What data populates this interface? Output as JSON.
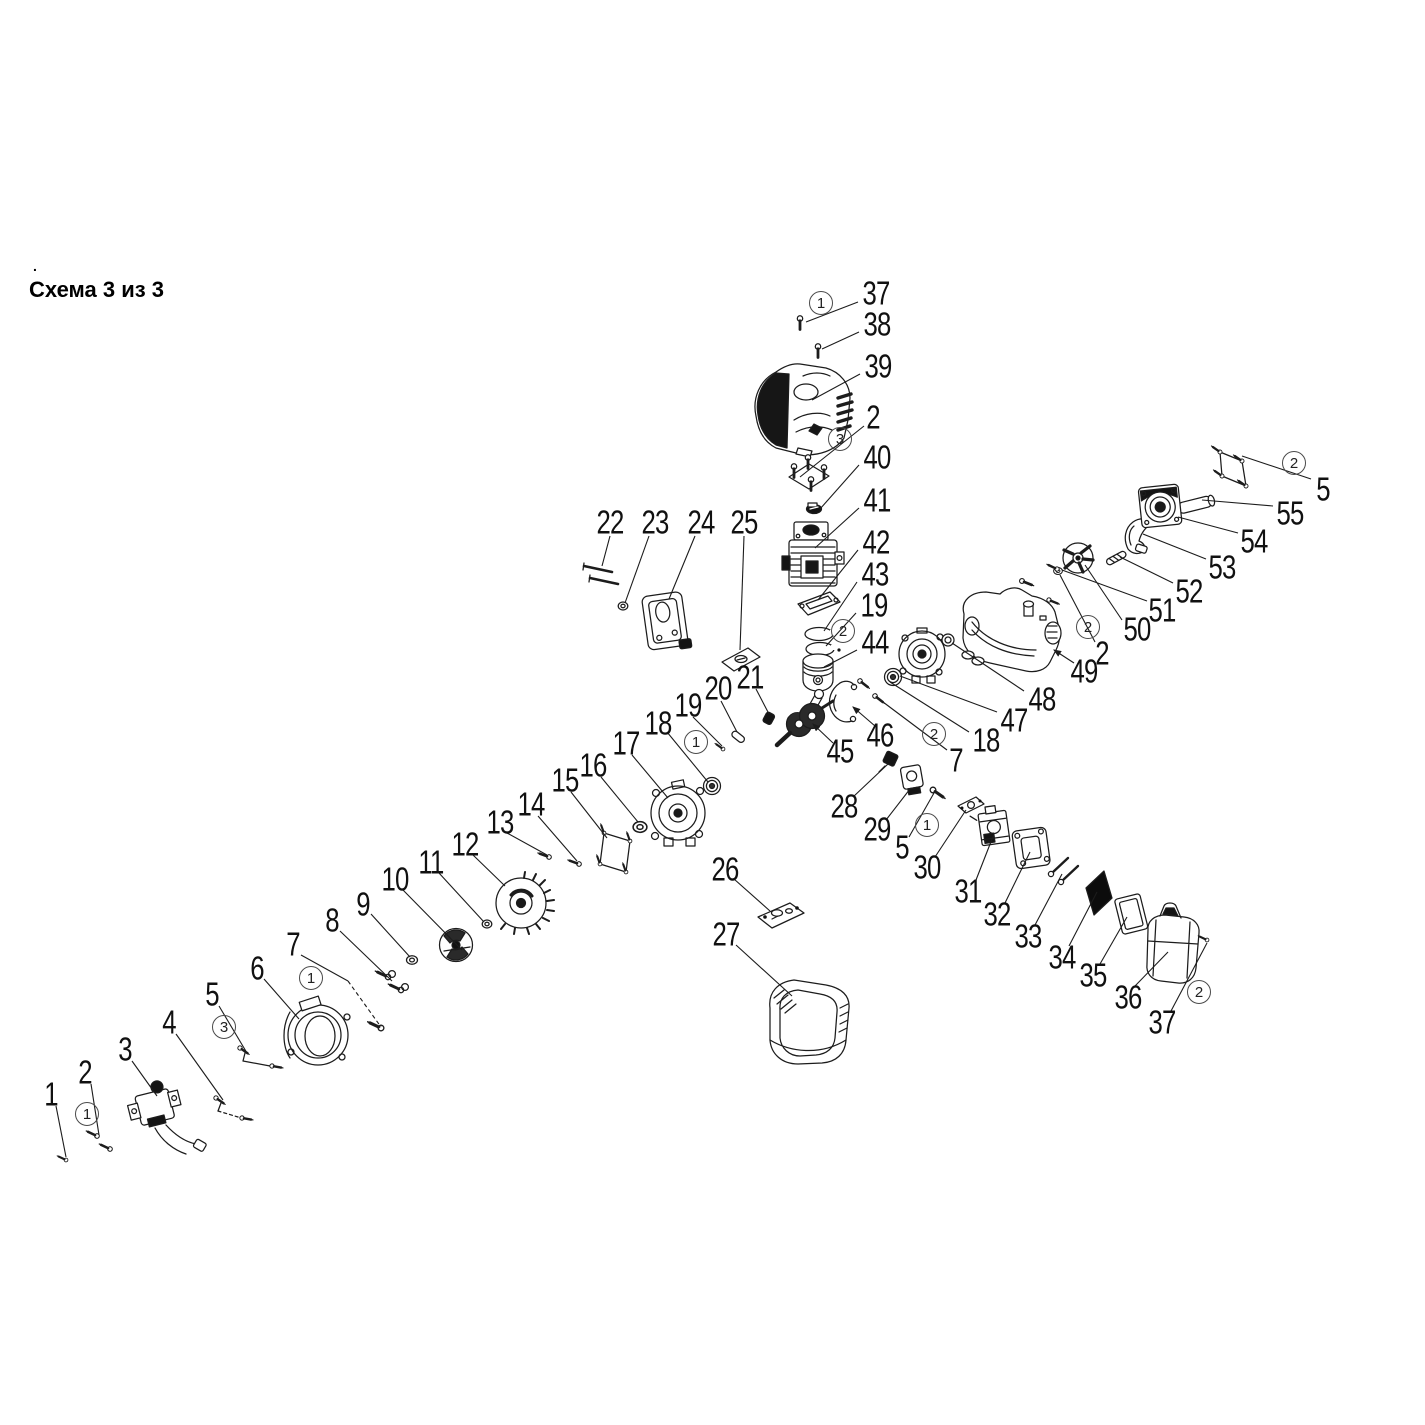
{
  "header": {
    "title": "Схема 3 из 3",
    "dot": "."
  },
  "diagram": {
    "type": "exploded-parts-diagram",
    "callouts": [
      {
        "t": "37",
        "x": 876,
        "y": 293,
        "lead": [
          [
            858,
            302
          ],
          [
            806,
            322
          ]
        ]
      },
      {
        "t": "38",
        "x": 877,
        "y": 324,
        "lead": [
          [
            859,
            332
          ],
          [
            822,
            349
          ]
        ]
      },
      {
        "t": "39",
        "x": 878,
        "y": 366,
        "lead": [
          [
            860,
            374
          ],
          [
            812,
            400
          ]
        ]
      },
      {
        "t": "2",
        "x": 873,
        "y": 417,
        "lead": [
          [
            864,
            426
          ],
          [
            800,
            477
          ]
        ]
      },
      {
        "t": "40",
        "x": 877,
        "y": 457,
        "lead": [
          [
            859,
            465
          ],
          [
            820,
            509
          ]
        ]
      },
      {
        "t": "41",
        "x": 877,
        "y": 500,
        "lead": [
          [
            859,
            508
          ],
          [
            815,
            548
          ]
        ]
      },
      {
        "t": "42",
        "x": 876,
        "y": 542,
        "lead": [
          [
            858,
            550
          ],
          [
            818,
            600
          ]
        ]
      },
      {
        "t": "43",
        "x": 875,
        "y": 574,
        "lead": [
          [
            857,
            582
          ],
          [
            824,
            631
          ]
        ]
      },
      {
        "t": "19",
        "x": 874,
        "y": 605,
        "lead": [
          [
            856,
            613
          ],
          [
            826,
            646
          ]
        ]
      },
      {
        "t": "44",
        "x": 875,
        "y": 642,
        "lead": [
          [
            857,
            650
          ],
          [
            824,
            667
          ]
        ]
      },
      {
        "t": "45",
        "x": 840,
        "y": 751,
        "lead": [
          [
            833,
            743
          ],
          [
            813,
            724
          ]
        ],
        "arrow": true
      },
      {
        "t": "46",
        "x": 880,
        "y": 735,
        "lead": [
          [
            875,
            726
          ],
          [
            853,
            707
          ]
        ],
        "arrow": true
      },
      {
        "t": "47",
        "x": 1014,
        "y": 720,
        "lead": [
          [
            997,
            712
          ],
          [
            900,
            676
          ]
        ]
      },
      {
        "t": "48",
        "x": 1042,
        "y": 699,
        "lead": [
          [
            1024,
            691
          ],
          [
            952,
            643
          ]
        ]
      },
      {
        "t": "18",
        "x": 986,
        "y": 740,
        "lead": [
          [
            969,
            732
          ],
          [
            890,
            682
          ]
        ]
      },
      {
        "t": "7",
        "x": 956,
        "y": 760,
        "lead": [
          [
            947,
            750
          ],
          [
            879,
            699
          ]
        ]
      },
      {
        "t": "49",
        "x": 1084,
        "y": 671,
        "lead": [
          [
            1074,
            663
          ],
          [
            1054,
            650
          ]
        ],
        "arrow": true
      },
      {
        "t": "2",
        "x": 1102,
        "y": 653,
        "lead": [
          [
            1095,
            642
          ],
          [
            1060,
            575
          ]
        ]
      },
      {
        "t": "50",
        "x": 1137,
        "y": 629,
        "lead": [
          [
            1122,
            620
          ],
          [
            1085,
            565
          ]
        ]
      },
      {
        "t": "51",
        "x": 1162,
        "y": 610,
        "lead": [
          [
            1147,
            601
          ],
          [
            1062,
            570
          ]
        ]
      },
      {
        "t": "52",
        "x": 1189,
        "y": 591,
        "lead": [
          [
            1173,
            583
          ],
          [
            1120,
            557
          ]
        ]
      },
      {
        "t": "53",
        "x": 1222,
        "y": 567,
        "lead": [
          [
            1206,
            559
          ],
          [
            1143,
            534
          ]
        ]
      },
      {
        "t": "54",
        "x": 1254,
        "y": 541,
        "lead": [
          [
            1238,
            533
          ],
          [
            1178,
            517
          ]
        ]
      },
      {
        "t": "55",
        "x": 1290,
        "y": 513,
        "lead": [
          [
            1273,
            506
          ],
          [
            1202,
            500
          ]
        ]
      },
      {
        "t": "5",
        "x": 1323,
        "y": 489,
        "lead": [
          [
            1311,
            479
          ],
          [
            1242,
            456
          ]
        ]
      },
      {
        "t": "22",
        "x": 610,
        "y": 522,
        "lead": [
          [
            610,
            536
          ],
          [
            602,
            566
          ]
        ]
      },
      {
        "t": "23",
        "x": 655,
        "y": 522,
        "lead": [
          [
            649,
            536
          ],
          [
            625,
            603
          ]
        ]
      },
      {
        "t": "24",
        "x": 701,
        "y": 522,
        "lead": [
          [
            695,
            536
          ],
          [
            669,
            599
          ]
        ]
      },
      {
        "t": "25",
        "x": 744,
        "y": 522,
        "lead": [
          [
            744,
            536
          ],
          [
            740,
            650
          ]
        ]
      },
      {
        "t": "21",
        "x": 750,
        "y": 677,
        "lead": [
          [
            756,
            689
          ],
          [
            769,
            714
          ]
        ]
      },
      {
        "t": "20",
        "x": 718,
        "y": 688,
        "lead": [
          [
            721,
            701
          ],
          [
            737,
            732
          ]
        ]
      },
      {
        "t": "19",
        "x": 688,
        "y": 705,
        "lead": [
          [
            693,
            717
          ],
          [
            722,
            746
          ]
        ]
      },
      {
        "t": "18",
        "x": 658,
        "y": 723,
        "lead": [
          [
            667,
            732
          ],
          [
            708,
            782
          ]
        ]
      },
      {
        "t": "17",
        "x": 626,
        "y": 743,
        "lead": [
          [
            632,
            755
          ],
          [
            668,
            798
          ]
        ]
      },
      {
        "t": "16",
        "x": 593,
        "y": 765,
        "lead": [
          [
            601,
            777
          ],
          [
            638,
            822
          ]
        ]
      },
      {
        "t": "15",
        "x": 565,
        "y": 780,
        "lead": [
          [
            571,
            792
          ],
          [
            607,
            838
          ]
        ]
      },
      {
        "t": "14",
        "x": 531,
        "y": 804,
        "lead": [
          [
            538,
            816
          ],
          [
            577,
            861
          ]
        ]
      },
      {
        "t": "13",
        "x": 500,
        "y": 822,
        "lead": [
          [
            507,
            833
          ],
          [
            547,
            855
          ]
        ]
      },
      {
        "t": "12",
        "x": 465,
        "y": 844,
        "lead": [
          [
            473,
            855
          ],
          [
            505,
            886
          ]
        ]
      },
      {
        "t": "11",
        "x": 431,
        "y": 862,
        "lead": [
          [
            439,
            873
          ],
          [
            484,
            922
          ]
        ]
      },
      {
        "t": "10",
        "x": 395,
        "y": 879,
        "lead": [
          [
            403,
            890
          ],
          [
            462,
            950
          ]
        ]
      },
      {
        "t": "9",
        "x": 363,
        "y": 904,
        "lead": [
          [
            371,
            914
          ],
          [
            410,
            957
          ]
        ]
      },
      {
        "t": "8",
        "x": 332,
        "y": 920,
        "lead": [
          [
            340,
            931
          ],
          [
            392,
            981
          ]
        ]
      },
      {
        "t": "7",
        "x": 293,
        "y": 944,
        "lead": [
          [
            301,
            955
          ],
          [
            348,
            981
          ]
        ],
        "lead2": [
          [
            348,
            981
          ],
          [
            381,
            1027
          ]
        ]
      },
      {
        "t": "6",
        "x": 257,
        "y": 968,
        "lead": [
          [
            264,
            979
          ],
          [
            299,
            1019
          ]
        ]
      },
      {
        "t": "5",
        "x": 212,
        "y": 994,
        "lead": [
          [
            219,
            1006
          ],
          [
            247,
            1053
          ]
        ]
      },
      {
        "t": "4",
        "x": 169,
        "y": 1022,
        "lead": [
          [
            176,
            1034
          ],
          [
            223,
            1100
          ]
        ]
      },
      {
        "t": "3",
        "x": 125,
        "y": 1049,
        "lead": [
          [
            132,
            1061
          ],
          [
            157,
            1096
          ]
        ]
      },
      {
        "t": "2",
        "x": 85,
        "y": 1072,
        "lead": [
          [
            91,
            1084
          ],
          [
            99,
            1135
          ]
        ]
      },
      {
        "t": "1",
        "x": 51,
        "y": 1094,
        "lead": [
          [
            56,
            1106
          ],
          [
            66,
            1157
          ]
        ]
      },
      {
        "t": "26",
        "x": 725,
        "y": 869,
        "lead": [
          [
            734,
            879
          ],
          [
            770,
            911
          ]
        ]
      },
      {
        "t": "27",
        "x": 726,
        "y": 934,
        "lead": [
          [
            736,
            945
          ],
          [
            792,
            996
          ]
        ]
      },
      {
        "t": "28",
        "x": 844,
        "y": 806,
        "lead": [
          [
            853,
            797
          ],
          [
            888,
            764
          ]
        ]
      },
      {
        "t": "29",
        "x": 877,
        "y": 829,
        "lead": [
          [
            886,
            820
          ],
          [
            910,
            789
          ]
        ]
      },
      {
        "t": "5",
        "x": 902,
        "y": 847,
        "lead": [
          [
            909,
            837
          ],
          [
            934,
            793
          ]
        ]
      },
      {
        "t": "30",
        "x": 927,
        "y": 867,
        "lead": [
          [
            935,
            857
          ],
          [
            966,
            810
          ]
        ]
      },
      {
        "t": "31",
        "x": 968,
        "y": 891,
        "lead": [
          [
            976,
            880
          ],
          [
            994,
            834
          ]
        ]
      },
      {
        "t": "32",
        "x": 997,
        "y": 914,
        "lead": [
          [
            1005,
            903
          ],
          [
            1030,
            852
          ]
        ]
      },
      {
        "t": "33",
        "x": 1028,
        "y": 936,
        "lead": [
          [
            1035,
            925
          ],
          [
            1062,
            874
          ]
        ]
      },
      {
        "t": "34",
        "x": 1062,
        "y": 957,
        "lead": [
          [
            1069,
            946
          ],
          [
            1097,
            892
          ]
        ]
      },
      {
        "t": "35",
        "x": 1093,
        "y": 975,
        "lead": [
          [
            1100,
            964
          ],
          [
            1127,
            917
          ]
        ]
      },
      {
        "t": "36",
        "x": 1128,
        "y": 997,
        "lead": [
          [
            1135,
            986
          ],
          [
            1168,
            952
          ]
        ]
      },
      {
        "t": "37",
        "x": 1162,
        "y": 1022,
        "lead": [
          [
            1171,
            1011
          ],
          [
            1207,
            943
          ]
        ]
      }
    ],
    "quantity_badges": [
      {
        "t": "1",
        "x": 821,
        "y": 303
      },
      {
        "t": "1",
        "x": 696,
        "y": 742
      },
      {
        "t": "1",
        "x": 311,
        "y": 978
      },
      {
        "t": "1",
        "x": 927,
        "y": 825
      },
      {
        "t": "1",
        "x": 87,
        "y": 1114
      },
      {
        "t": "2",
        "x": 843,
        "y": 631
      },
      {
        "t": "2",
        "x": 934,
        "y": 734
      },
      {
        "t": "2",
        "x": 1088,
        "y": 627
      },
      {
        "t": "2",
        "x": 1294,
        "y": 463
      },
      {
        "t": "2",
        "x": 1199,
        "y": 992
      },
      {
        "t": "3",
        "x": 840,
        "y": 439
      },
      {
        "t": "3",
        "x": 224,
        "y": 1027
      }
    ]
  }
}
